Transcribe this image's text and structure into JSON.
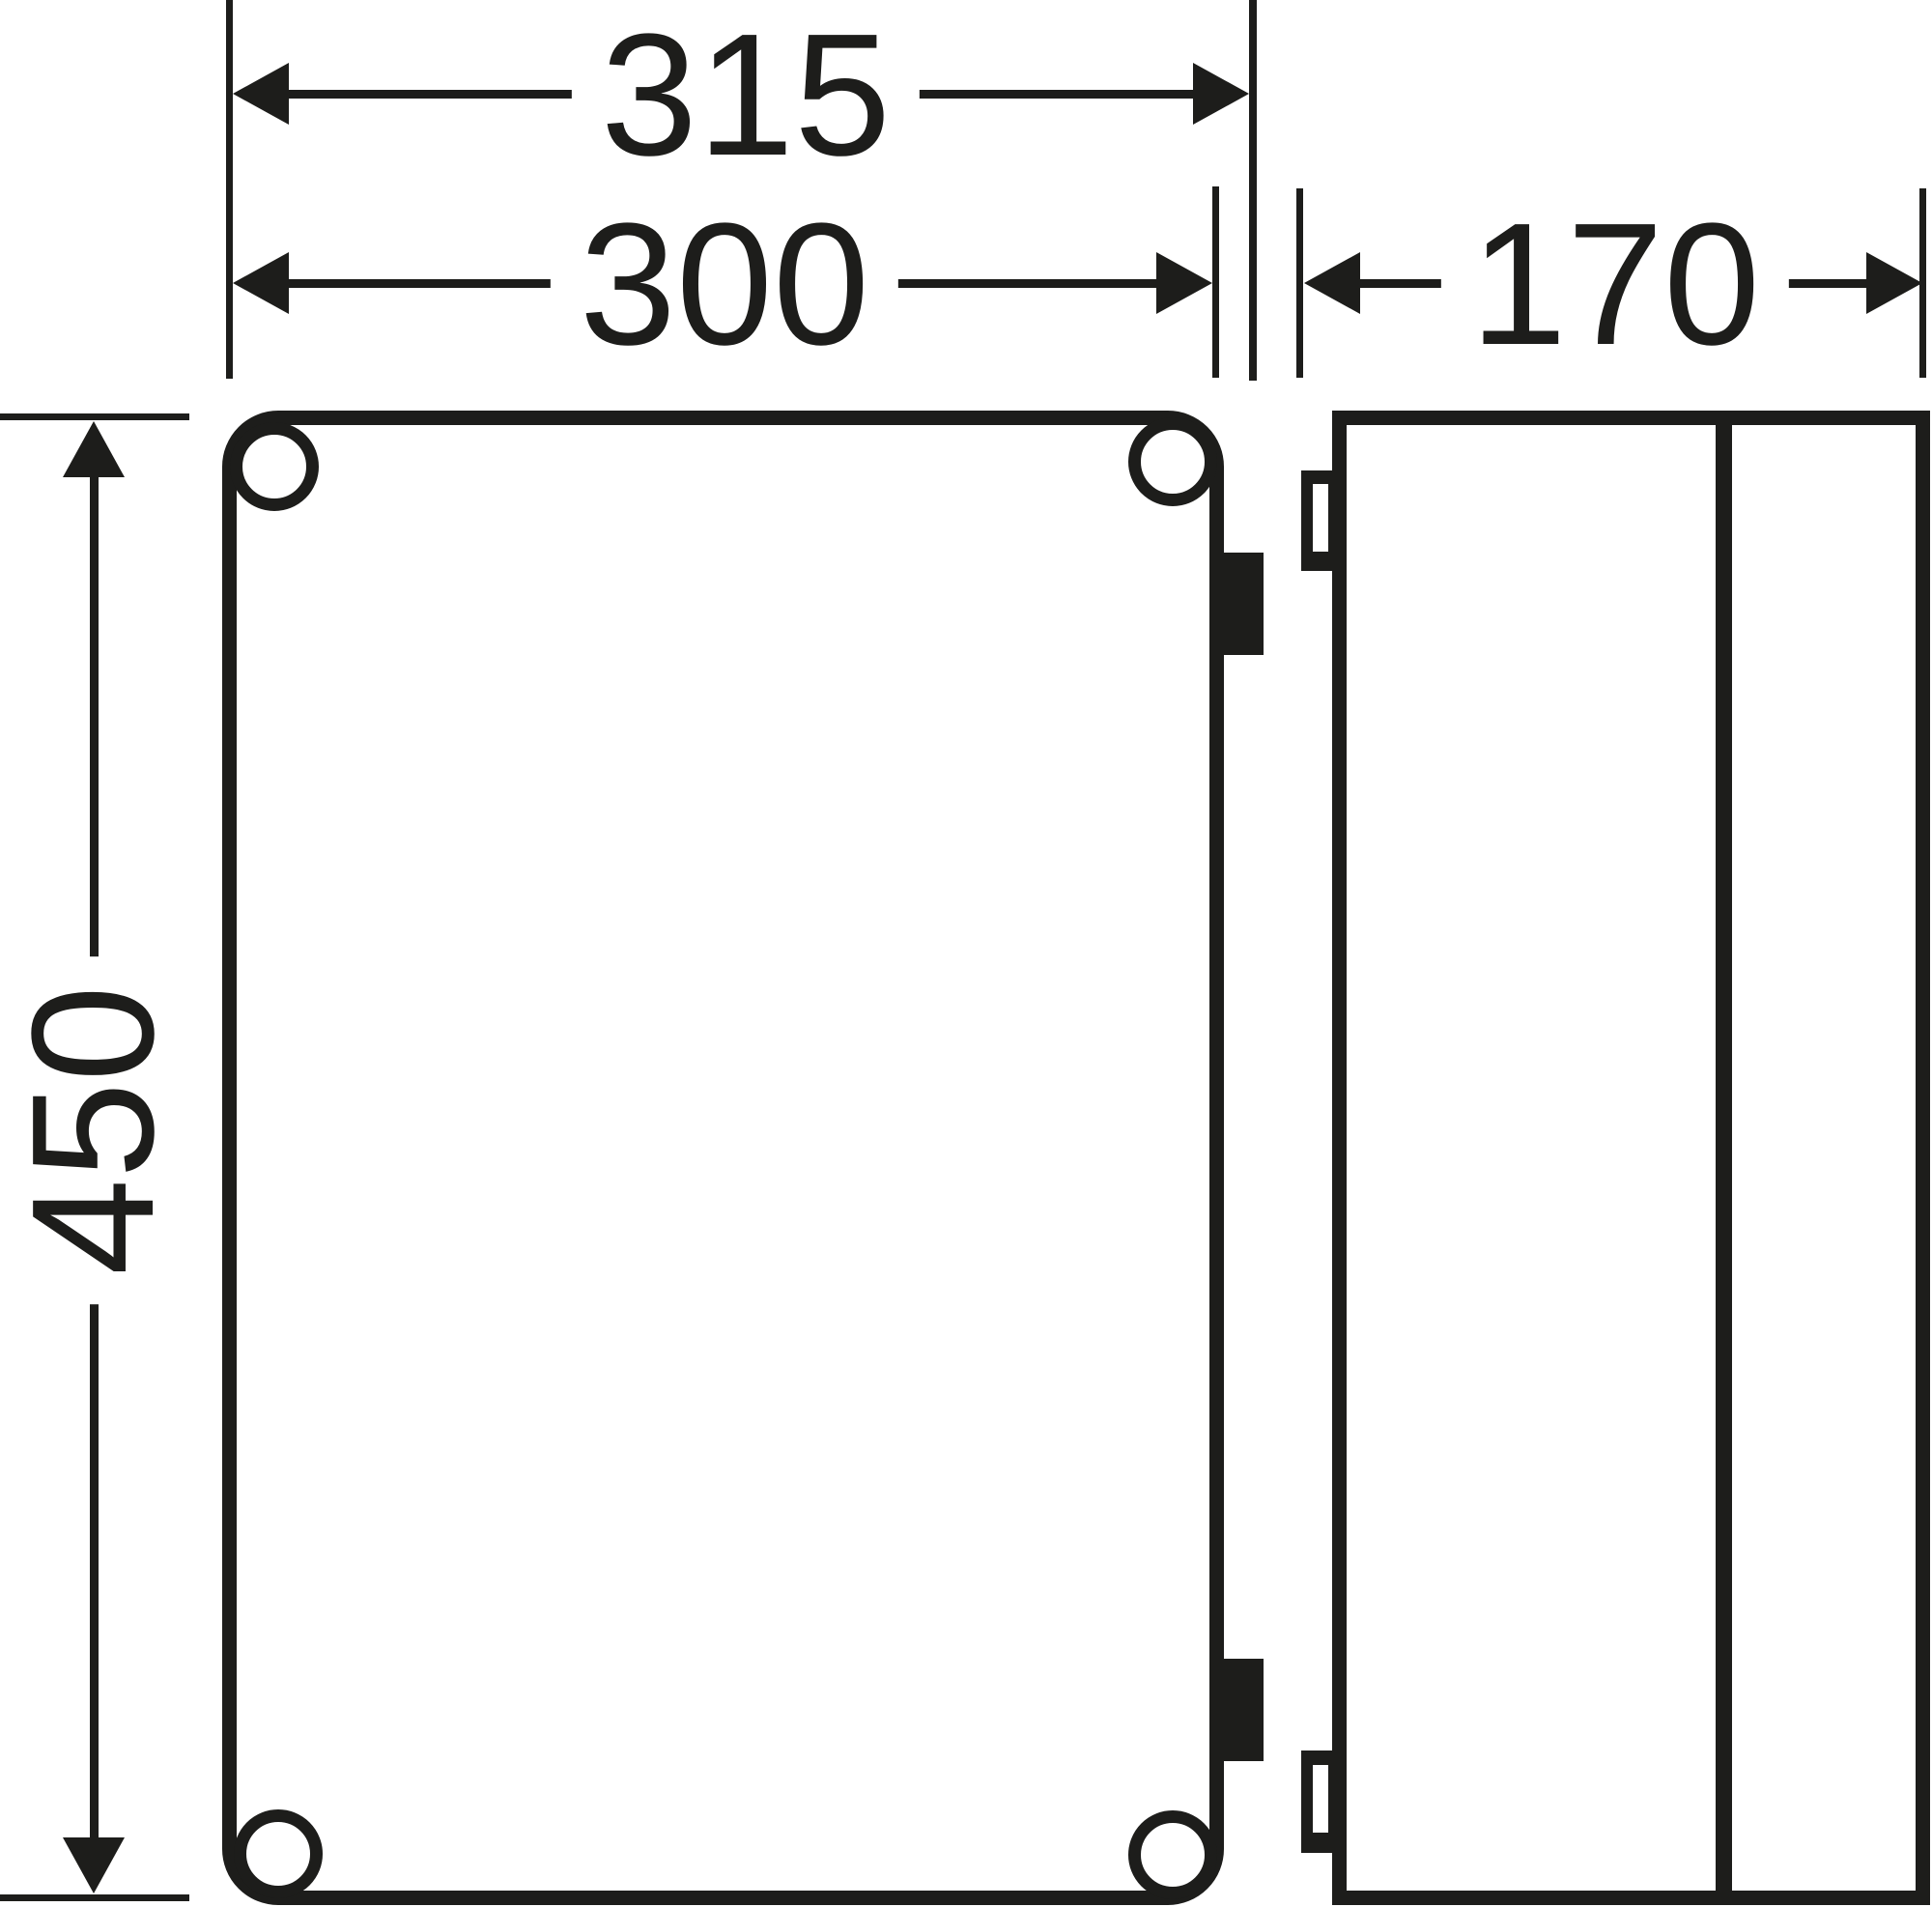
{
  "diagram": {
    "kind": "enclosure-dimension-drawing",
    "background": "#ffffff",
    "line_color": "#1d1d1b"
  },
  "dimensions": {
    "overall_width": {
      "label": "315"
    },
    "cover_width": {
      "label": "300"
    },
    "depth": {
      "label": "170"
    },
    "height": {
      "label": "450"
    }
  }
}
